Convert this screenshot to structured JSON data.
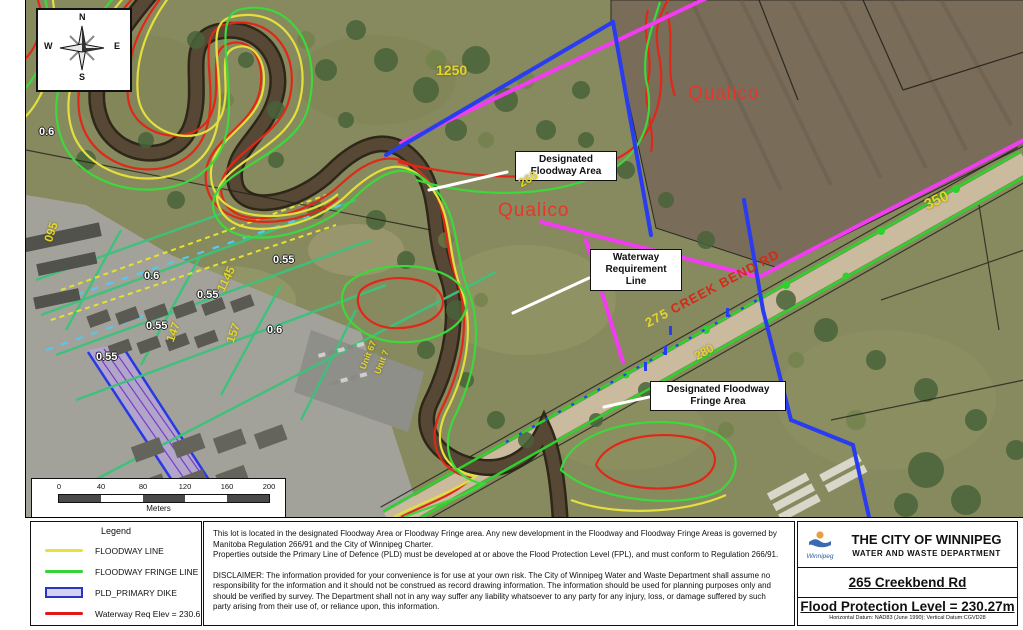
{
  "compass": {
    "n": "N",
    "e": "E",
    "s": "S",
    "w": "W"
  },
  "map": {
    "callouts": {
      "floodway_area": "Designated\nFloodway Area",
      "waterway_line": "Waterway\nRequirement\nLine",
      "fringe_area": "Designated Floodway\nFringe Area"
    },
    "area_labels": {
      "qualico_north": "Qualico",
      "qualico_south": "Qualico"
    },
    "road": {
      "number": "275",
      "name": "CREEK BEND RD"
    },
    "address_labels": {
      "a1250": "1250",
      "a265": "265",
      "a350": "350",
      "a280": "280",
      "a095": "095",
      "a1145": "1145",
      "a147": "147",
      "a157": "157",
      "unit67": "Unit 67",
      "unit7": "Unit 7"
    },
    "elevation_labels": {
      "e1": "0.6",
      "e2": "0.6",
      "e3": "0.6",
      "e4": "0.55",
      "e5": "0.55",
      "e6": "0.55",
      "e7": "0.55"
    },
    "colors": {
      "magenta_line": "#f23cf2",
      "blue_line": "#2a3cf0",
      "teal_line": "#3cc27c",
      "road_green": "#2ed12e",
      "contour_yellow": "#e3df3c",
      "contour_green": "#3cd83c",
      "contour_red": "#e02818",
      "dike_purple": "#7a3cc8"
    }
  },
  "scalebar": {
    "ticks": [
      "0",
      "40",
      "80",
      "120",
      "160",
      "200"
    ],
    "unit": "Meters"
  },
  "legend": {
    "title": "Legend",
    "items": [
      {
        "label": "FLOODWAY LINE",
        "color": "#e8e339",
        "type": "line"
      },
      {
        "label": "FLOODWAY FRINGE LINE",
        "color": "#35d435",
        "type": "line"
      },
      {
        "label": "PLD_PRIMARY DIKE",
        "color": "#2a35c8",
        "fill": "#d4d4f0",
        "type": "box"
      },
      {
        "label": "Waterway Req Elev = 230.6",
        "color": "#e11818",
        "type": "line"
      }
    ]
  },
  "notes": {
    "paragraph": "This lot is located in the designated  Floodway Area or Floodway Fringe area.  Any new development in the Floodway and Floodway Fringe Areas is governed by Manitoba Regulation 266/91 and the City of Winnipeg Charter.\nProperties outside the Primary Line of Defence (PLD) must be developed at or above the Flood Protection Level (FPL), and must conform to Regulation 266/91.",
    "disclaimer": "DISCLAIMER: The information provided for your convenience is for use at your own risk. The City of Winnipeg Water and Waste Department shall assume no responsibility for the information and it should not be construed as record drawing information.  The information should be used for planning purposes only and should be verified by survey. The Department shall not in any way suffer any liability whatsoever to any party for any injury, loss, or damage suffered by such party arising from their use of, or reliance upon, this information."
  },
  "titleblock": {
    "logo_text": "Winnipeg",
    "org": "THE CITY OF WINNIPEG",
    "dept": "WATER AND WASTE DEPARTMENT",
    "address": "265 Creekbend Rd",
    "fpl": "Flood Protection Level = 230.27m",
    "datum": "Horizontal Datum: NAD83 (June 1990); Vertical Datum:CGVD28"
  }
}
